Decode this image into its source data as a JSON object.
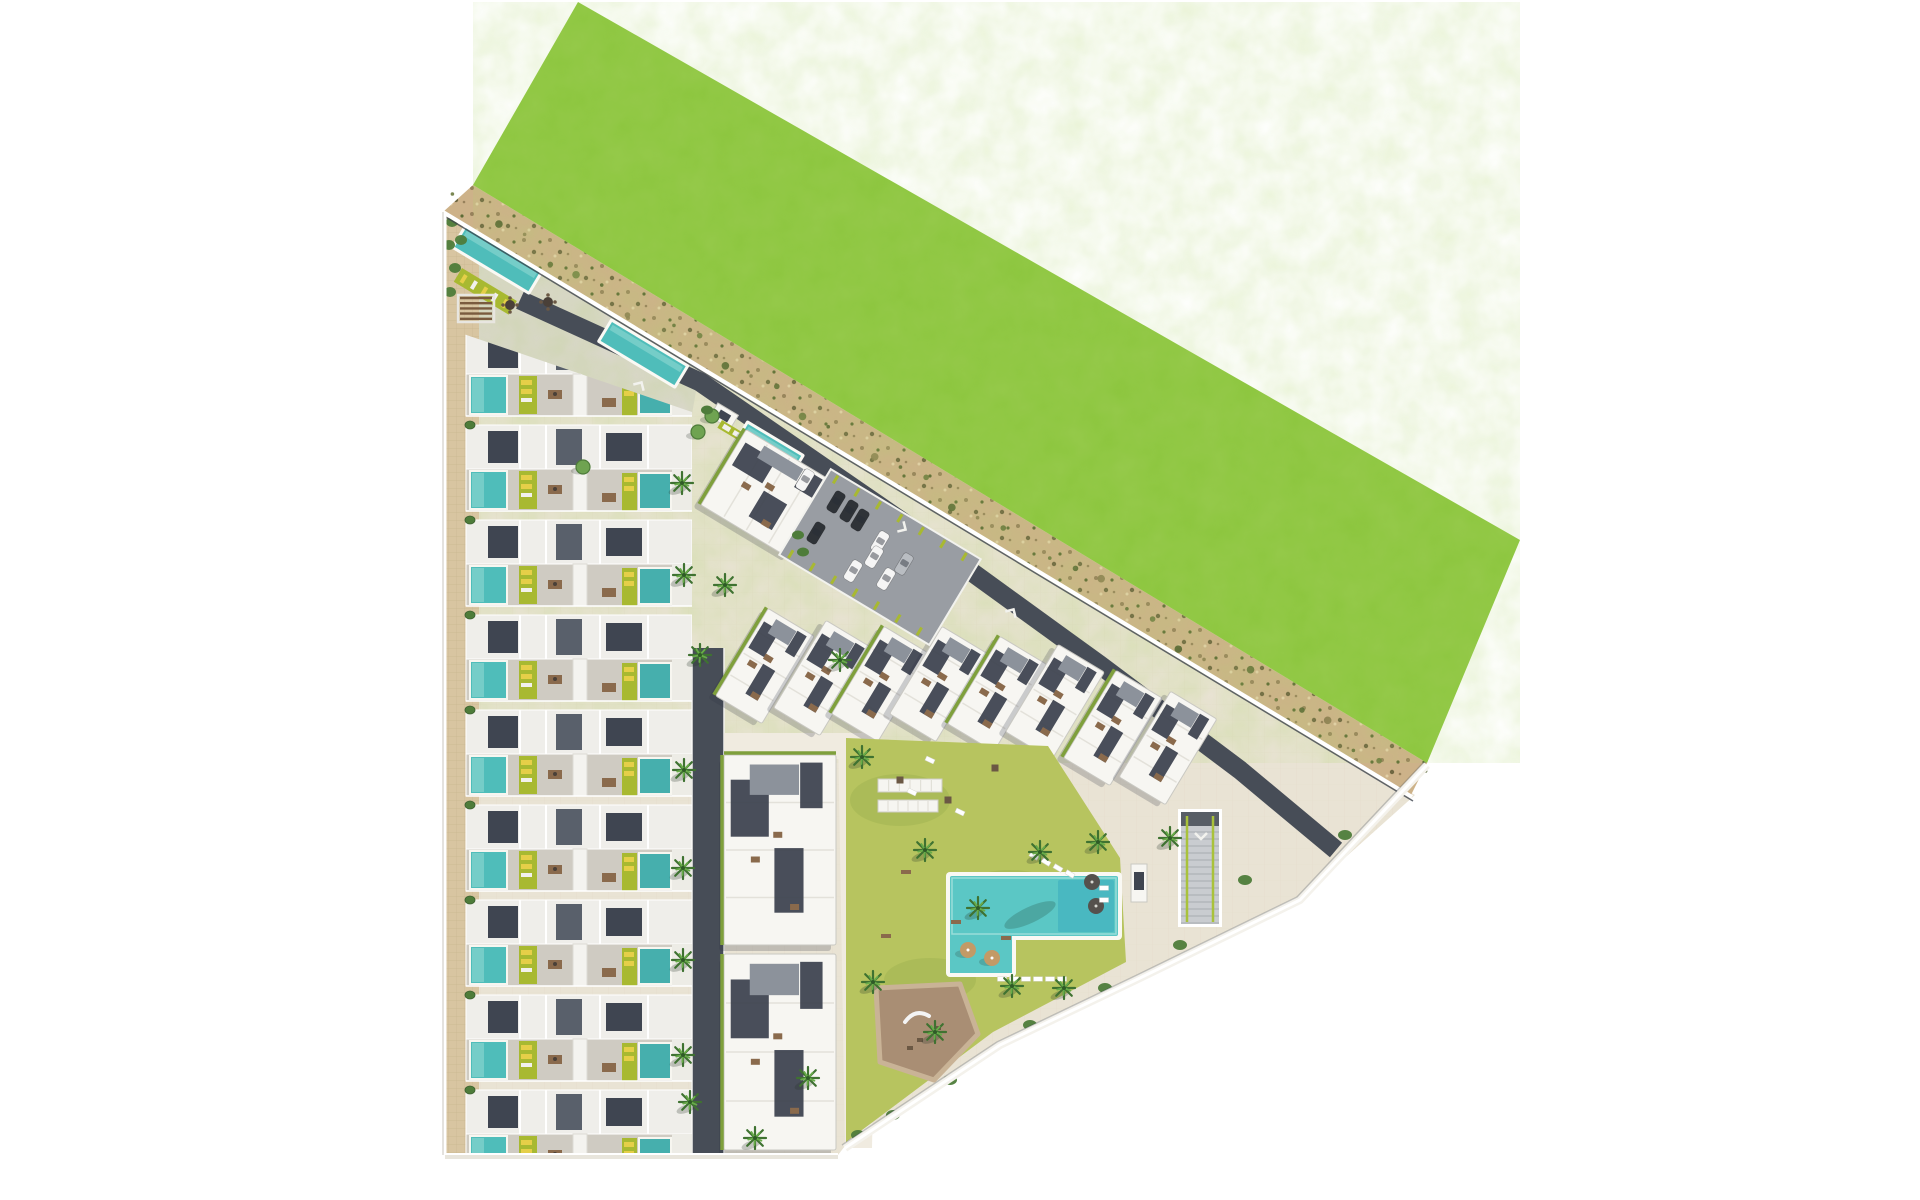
{
  "meta": {
    "description": "Aerial top-down 3D masterplan rendering of a residential development: rows of townhouses with private pools on the left, angled apartment blocks along a sandy perimeter road, a large green field to the north-east, communal lawn with swimming pool, playground, gardens, parking lot and underground-parking ramp.",
    "canvas": {
      "w": 1920,
      "h": 1200
    }
  },
  "palette": {
    "bg": "#ffffff",
    "grass": "#8cc63e",
    "grass_noise": "0 0 0 0 0.44  0 0 0 0 0.66  0 0 0 0 0.16  0 0 0 0.55 0",
    "sand": "#cdb289",
    "site": "#e9e3d4",
    "entrance_paving": "#dbd7cd",
    "sidewalk": "#d8c5a1",
    "dark_road": "#474d57",
    "asphalt": "#999da3",
    "path": "#f0ebe0",
    "pool": "#4fbdba",
    "pool_light": "#7ed1cc",
    "pool_dark": "#37a9be",
    "big_pool": "#5bc7c5",
    "deck": "#faf9f4",
    "lime": "#a8b931",
    "yellow": "#e5cf48",
    "lawn": "#b7c45f",
    "slate": "#3f4551",
    "slate2": "#59606b",
    "roof_white": "#f7f6f2",
    "house_band": "#efeeea",
    "terrace": "#cfcbc2",
    "block_edge": "#c9c8c2",
    "hedge": "#7fa03c",
    "palm_dark": "#3f7231",
    "palm_light": "#68ac49",
    "tree": "#6fa351",
    "bush": "#4e7c3a",
    "playground": "#a98e74",
    "playground_ring": "#c9b396",
    "pergola_wood": "#7a5b3f",
    "furniture": "#8a6a4c",
    "furniture_dark": "#4a4038",
    "umbrella_tan": "#c39a66",
    "umbrella_dark": "#55514d",
    "car_white": "#f5f5f5",
    "car_black": "#2f3338",
    "car_gray": "#b9bdc2",
    "wall_white": "#ffffff",
    "wall_dark": "#3e444d",
    "shadow": "rgba(45,52,70,0.22)"
  },
  "green_field": {
    "polygon": [
      [
        578,
        2
      ],
      [
        1520,
        540
      ],
      [
        1427,
        763
      ],
      [
        473,
        185
      ]
    ]
  },
  "sand_road": {
    "polygon": [
      [
        473,
        185
      ],
      [
        1427,
        763
      ],
      [
        1410,
        797
      ],
      [
        443,
        212
      ]
    ],
    "veg_line": {
      "a": [
        462,
        203
      ],
      "b": [
        1416,
        780
      ]
    }
  },
  "site": {
    "polygon": [
      [
        445,
        212
      ],
      [
        1415,
        795
      ],
      [
        1300,
        898
      ],
      [
        1140,
        976
      ],
      [
        1000,
        1043
      ],
      [
        845,
        1146
      ],
      [
        838,
        1155
      ],
      [
        445,
        1155
      ]
    ]
  },
  "entrance_paving": {
    "polygon": [
      [
        446,
        214
      ],
      [
        700,
        368
      ],
      [
        692,
        414
      ],
      [
        446,
        330
      ]
    ]
  },
  "sidewalk": {
    "polygon": [
      [
        445,
        213
      ],
      [
        479,
        234
      ],
      [
        479,
        1155
      ],
      [
        445,
        1155
      ]
    ]
  },
  "roads": {
    "wall_road": {
      "pts": [
        [
          520,
          300
        ],
        [
          700,
          382
        ],
        [
          900,
          520
        ],
        [
          1100,
          665
        ],
        [
          1240,
          770
        ],
        [
          1336,
          850
        ]
      ],
      "w": 19
    },
    "south_road": {
      "x": 692,
      "y": 648,
      "w": 32,
      "h": 507
    },
    "paths": [
      {
        "polygon": [
          [
            724,
            733
          ],
          [
            880,
            733
          ],
          [
            880,
            759
          ],
          [
            724,
            759
          ]
        ]
      },
      {
        "polygon": [
          [
            838,
            733
          ],
          [
            880,
            733
          ],
          [
            872,
            1148
          ],
          [
            845,
            1148
          ]
        ]
      }
    ],
    "trails": [
      {
        "d": "M858,770 Q880,830 930,856"
      },
      {
        "d": "M870,1060 Q920,1040 988,1028"
      }
    ],
    "arrows": [
      {
        "x": 640,
        "y": 385,
        "rot": 31
      },
      {
        "x": 903,
        "y": 528,
        "rot": 121
      },
      {
        "x": 1012,
        "y": 612,
        "rot": 31
      },
      {
        "x": 1201,
        "y": 836,
        "rot": 180
      }
    ]
  },
  "townhouses": {
    "clip": [
      [
        446,
        328
      ],
      [
        692,
        412
      ],
      [
        692,
        1155
      ],
      [
        446,
        1155
      ]
    ],
    "x0": 466,
    "x1": 692,
    "top": 330,
    "module_h": 95,
    "count": 9,
    "sidewalk_bushes_x": 470,
    "sidewalk_bushes_y": [
      425,
      520,
      615,
      710,
      805,
      900,
      995,
      1090
    ]
  },
  "wall_pools": [
    {
      "x": 466,
      "y": 228,
      "len": 86,
      "w": 22,
      "rot": 31
    },
    {
      "x": 612,
      "y": 322,
      "len": 86,
      "w": 22,
      "rot": 31
    },
    {
      "x": 748,
      "y": 424,
      "len": 62,
      "w": 20,
      "rot": 31
    }
  ],
  "entrance": {
    "sun_lawn": {
      "x": 462,
      "y": 268,
      "len": 64,
      "w": 16,
      "rot": 31
    },
    "pergola": {
      "x": 458,
      "y": 295,
      "w": 36,
      "h": 27
    },
    "tables": [
      [
        510,
        305
      ],
      [
        548,
        302
      ]
    ],
    "bushes": [
      [
        452,
        222
      ],
      [
        449,
        245
      ],
      [
        455,
        268
      ],
      [
        450,
        292
      ],
      [
        461,
        240
      ]
    ]
  },
  "kiosk": {
    "cx": 724,
    "cy": 416,
    "w": 24,
    "h": 16,
    "rot": 31
  },
  "lime_bar": {
    "x": 722,
    "y": 420,
    "len": 30,
    "w": 9,
    "rot": 31
  },
  "blocks": [
    {
      "cx": 768,
      "cy": 494,
      "w": 104,
      "h": 88,
      "rot": 31,
      "hedge": [
        "left"
      ]
    },
    {
      "cx": 765,
      "cy": 666,
      "w": 54,
      "h": 102,
      "rot": 31,
      "hedge": [
        "left"
      ]
    },
    {
      "cx": 823,
      "cy": 678,
      "w": 54,
      "h": 102,
      "rot": 31,
      "hedge": []
    },
    {
      "cx": 881,
      "cy": 684,
      "w": 54,
      "h": 102,
      "rot": 31,
      "hedge": [
        "left"
      ]
    },
    {
      "cx": 939,
      "cy": 684,
      "w": 54,
      "h": 102,
      "rot": 31,
      "hedge": []
    },
    {
      "cx": 997,
      "cy": 694,
      "w": 54,
      "h": 102,
      "rot": 31,
      "hedge": [
        "left"
      ]
    },
    {
      "cx": 1055,
      "cy": 702,
      "w": 54,
      "h": 102,
      "rot": 31,
      "hedge": []
    },
    {
      "cx": 1113,
      "cy": 728,
      "w": 54,
      "h": 102,
      "rot": 31,
      "hedge": [
        "left"
      ]
    },
    {
      "cx": 1168,
      "cy": 748,
      "w": 54,
      "h": 100,
      "rot": 31,
      "hedge": []
    },
    {
      "cx": 780,
      "cy": 850,
      "w": 112,
      "h": 190,
      "rot": 0,
      "hedge": [
        "top",
        "left"
      ]
    },
    {
      "cx": 780,
      "cy": 1052,
      "w": 112,
      "h": 196,
      "rot": 0,
      "hedge": [
        "left"
      ]
    }
  ],
  "pavilion": {
    "x": 1131,
    "y": 864,
    "w": 16,
    "h": 38
  },
  "parking": {
    "cx": 880,
    "cy": 557,
    "rot": 31,
    "w": 175,
    "h": 100,
    "cars": [
      {
        "x": 805,
        "y": 480,
        "c": "car_white"
      },
      {
        "x": 836,
        "y": 502,
        "c": "car_black"
      },
      {
        "x": 849,
        "y": 511,
        "c": "car_black"
      },
      {
        "x": 860,
        "y": 520,
        "c": "car_black"
      },
      {
        "x": 816,
        "y": 533,
        "c": "car_black"
      },
      {
        "x": 880,
        "y": 542,
        "c": "car_white"
      },
      {
        "x": 874,
        "y": 557,
        "c": "car_white"
      },
      {
        "x": 853,
        "y": 571,
        "c": "car_white"
      },
      {
        "x": 886,
        "y": 579,
        "c": "car_white"
      },
      {
        "x": 904,
        "y": 564,
        "c": "car_gray"
      }
    ]
  },
  "ramp": {
    "x": 1181,
    "y": 812,
    "w": 38,
    "h": 112
  },
  "amenity": {
    "lawn": {
      "polygon": [
        [
          846,
          738
        ],
        [
          1048,
          746
        ],
        [
          1120,
          858
        ],
        [
          1126,
          962
        ],
        [
          993,
          1032
        ],
        [
          846,
          1142
        ]
      ]
    },
    "pool": {
      "main": {
        "x": 950,
        "y": 876,
        "w": 168,
        "h": 60
      },
      "lobe": {
        "x": 950,
        "y": 915,
        "w": 62,
        "h": 58
      },
      "dark": {
        "x": 1058,
        "y": 880,
        "w": 56,
        "h": 52
      }
    },
    "pergolas": [
      {
        "x": 878,
        "y": 779,
        "w": 64,
        "h": 13
      },
      {
        "x": 878,
        "y": 800,
        "w": 60,
        "h": 12
      }
    ],
    "umbrellas_tan": [
      [
        968,
        950
      ],
      [
        992,
        958
      ]
    ],
    "umbrellas_dark": [
      [
        1092,
        882
      ],
      [
        1096,
        906
      ]
    ],
    "loungers": [
      {
        "x": 1002,
        "y": 979,
        "rot": 0
      },
      {
        "x": 1014,
        "y": 979,
        "rot": 0
      },
      {
        "x": 1026,
        "y": 979,
        "rot": 0
      },
      {
        "x": 1038,
        "y": 979,
        "rot": 0
      },
      {
        "x": 1050,
        "y": 979,
        "rot": 0
      },
      {
        "x": 1062,
        "y": 979,
        "rot": 0
      },
      {
        "x": 1034,
        "y": 856,
        "rot": 31
      },
      {
        "x": 1046,
        "y": 862,
        "rot": 31
      },
      {
        "x": 1058,
        "y": 868,
        "rot": 31
      },
      {
        "x": 1070,
        "y": 874,
        "rot": 31
      },
      {
        "x": 1104,
        "y": 888,
        "rot": 0
      },
      {
        "x": 1104,
        "y": 900,
        "rot": 0
      },
      {
        "x": 912,
        "y": 792,
        "rot": 25
      },
      {
        "x": 960,
        "y": 812,
        "rot": 25
      },
      {
        "x": 930,
        "y": 760,
        "rot": 25
      }
    ],
    "cabanas": [
      [
        900,
        780
      ],
      [
        948,
        800
      ],
      [
        995,
        768
      ]
    ],
    "benches": [
      [
        906,
        872
      ],
      [
        956,
        922
      ],
      [
        1006,
        938
      ],
      [
        886,
        936
      ]
    ],
    "playground": {
      "polygon": [
        [
          876,
          988
        ],
        [
          960,
          984
        ],
        [
          978,
          1034
        ],
        [
          934,
          1080
        ],
        [
          880,
          1062
        ]
      ],
      "slide": "M905,1022 q10,-14 24,-6",
      "items": [
        [
          920,
          1040
        ],
        [
          938,
          1028
        ],
        [
          910,
          1048
        ]
      ]
    }
  },
  "palms": [
    [
      684,
      575
    ],
    [
      682,
      483
    ],
    [
      684,
      770
    ],
    [
      683,
      868
    ],
    [
      683,
      960
    ],
    [
      683,
      1055
    ],
    [
      690,
      1102
    ],
    [
      725,
      585
    ],
    [
      700,
      655
    ],
    [
      840,
      660
    ],
    [
      862,
      757
    ],
    [
      925,
      850
    ],
    [
      1040,
      852
    ],
    [
      1098,
      842
    ],
    [
      1170,
      838
    ],
    [
      978,
      908
    ],
    [
      1012,
      986
    ],
    [
      1064,
      988
    ],
    [
      935,
      1032
    ],
    [
      873,
      982
    ],
    [
      808,
      1078
    ],
    [
      755,
      1138
    ]
  ],
  "trees": [
    [
      712,
      416
    ],
    [
      698,
      432
    ],
    [
      583,
      467
    ]
  ],
  "bushes_extra": [
    [
      798,
      535
    ],
    [
      803,
      552
    ],
    [
      707,
      410
    ]
  ],
  "boundary_bushes": [
    [
      1345,
      835
    ],
    [
      1245,
      880
    ],
    [
      1180,
      945
    ],
    [
      1105,
      988
    ],
    [
      1030,
      1025
    ],
    [
      950,
      1080
    ],
    [
      893,
      1115
    ],
    [
      858,
      1135
    ]
  ],
  "boundary": {
    "ne_wall": {
      "a": [
        443,
        212
      ],
      "b": [
        1412,
        797
      ]
    },
    "left_wall": {
      "a": [
        445,
        212
      ],
      "b": [
        445,
        1155
      ]
    },
    "bottom_wall": {
      "a": [
        445,
        1156
      ],
      "b": [
        838,
        1156
      ]
    },
    "se_wall": [
      [
        1427,
        765
      ],
      [
        1300,
        900
      ],
      [
        1140,
        978
      ],
      [
        1000,
        1045
      ],
      [
        845,
        1148
      ]
    ]
  }
}
